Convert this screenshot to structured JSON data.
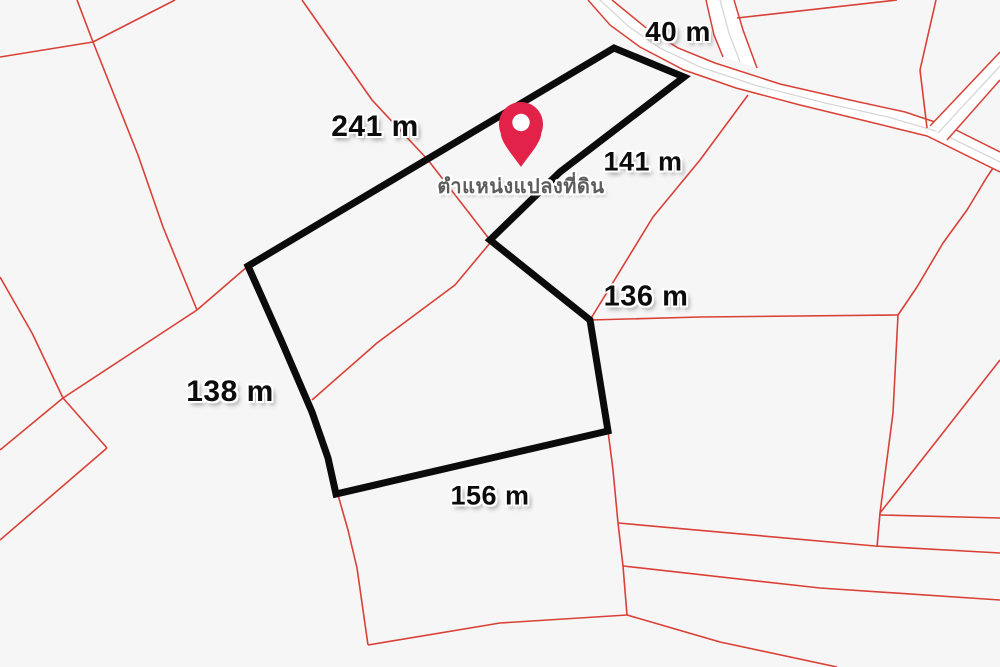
{
  "map": {
    "background_color": "#f6f6f7",
    "boundary_line_color": "#d94036",
    "road_fill_color": "#ffffff",
    "road_centerline_color": "#d7d7da",
    "parcel_outline_color": "#0b0b0b",
    "pin_color": "#e32249",
    "parcel_outline": [
      [
        248,
        266
      ],
      [
        614,
        48
      ],
      [
        684,
        77
      ],
      [
        560,
        172
      ],
      [
        490,
        240
      ],
      [
        590,
        320
      ],
      [
        608,
        431
      ],
      [
        336,
        494
      ],
      [
        328,
        458
      ],
      [
        312,
        412
      ],
      [
        281,
        340
      ]
    ],
    "red_lines": [
      [
        [
          77,
          0
        ],
        [
          93,
          42
        ]
      ],
      [
        [
          175,
          0
        ],
        [
          93,
          42
        ]
      ],
      [
        [
          0,
          57
        ],
        [
          93,
          42
        ]
      ],
      [
        [
          93,
          42
        ],
        [
          138,
          155
        ],
        [
          163,
          227
        ],
        [
          197,
          310
        ]
      ],
      [
        [
          197,
          310
        ],
        [
          248,
          266
        ]
      ],
      [
        [
          197,
          310
        ],
        [
          63,
          398
        ]
      ],
      [
        [
          0,
          277
        ],
        [
          32,
          333
        ],
        [
          63,
          398
        ]
      ],
      [
        [
          63,
          398
        ],
        [
          0,
          450
        ]
      ],
      [
        [
          63,
          398
        ],
        [
          107,
          448
        ]
      ],
      [
        [
          107,
          448
        ],
        [
          0,
          540
        ]
      ],
      [
        [
          302,
          0
        ],
        [
          372,
          100
        ],
        [
          428,
          160
        ],
        [
          490,
          240
        ]
      ],
      [
        [
          490,
          240
        ],
        [
          590,
          320
        ]
      ],
      [
        [
          590,
          320
        ],
        [
          700,
          317
        ],
        [
          898,
          315
        ]
      ],
      [
        [
          490,
          243
        ],
        [
          455,
          285
        ],
        [
          377,
          343
        ],
        [
          312,
          400
        ]
      ],
      [
        [
          338,
          495
        ],
        [
          348,
          530
        ],
        [
          357,
          568
        ],
        [
          368,
          645
        ]
      ],
      [
        [
          368,
          645
        ],
        [
          500,
          623
        ],
        [
          627,
          615
        ]
      ],
      [
        [
          608,
          431
        ],
        [
          613,
          470
        ],
        [
          618,
          523
        ],
        [
          623,
          566
        ],
        [
          627,
          615
        ]
      ],
      [
        [
          627,
          615
        ],
        [
          720,
          642
        ],
        [
          837,
          667
        ]
      ],
      [
        [
          618,
          523
        ],
        [
          875,
          546
        ],
        [
          1000,
          553
        ]
      ],
      [
        [
          623,
          566
        ],
        [
          820,
          588
        ],
        [
          1000,
          600
        ]
      ],
      [
        [
          898,
          315
        ],
        [
          893,
          413
        ],
        [
          880,
          513
        ],
        [
          877,
          547
        ]
      ],
      [
        [
          880,
          513
        ],
        [
          1000,
          360
        ]
      ],
      [
        [
          880,
          515
        ],
        [
          1000,
          518
        ]
      ],
      [
        [
          898,
          315
        ],
        [
          917,
          287
        ],
        [
          943,
          243
        ],
        [
          967,
          210
        ],
        [
          987,
          177
        ],
        [
          993,
          168
        ]
      ],
      [
        [
          936,
          0
        ],
        [
          920,
          70
        ],
        [
          927,
          128
        ]
      ],
      [
        [
          737,
          18
        ],
        [
          897,
          0
        ]
      ],
      [
        [
          590,
          320
        ],
        [
          653,
          217
        ],
        [
          700,
          160
        ],
        [
          748,
          95
        ]
      ]
    ],
    "roads": [
      {
        "name": "main-road",
        "edge_a": [
          [
            612,
            0
          ],
          [
            645,
            27
          ],
          [
            678,
            48
          ],
          [
            715,
            63
          ],
          [
            780,
            84
          ],
          [
            850,
            100
          ],
          [
            905,
            112
          ],
          [
            950,
            127
          ],
          [
            1000,
            152
          ]
        ],
        "edge_b": [
          [
            588,
            0
          ],
          [
            610,
            25
          ],
          [
            640,
            47
          ],
          [
            684,
            70
          ],
          [
            736,
            88
          ],
          [
            800,
            105
          ],
          [
            870,
            122
          ],
          [
            927,
            136
          ],
          [
            1000,
            172
          ]
        ],
        "centerline": [
          [
            600,
            0
          ],
          [
            628,
            26
          ],
          [
            660,
            48
          ],
          [
            700,
            67
          ],
          [
            758,
            86
          ],
          [
            825,
            103
          ],
          [
            888,
            117
          ],
          [
            939,
            132
          ],
          [
            1000,
            162
          ]
        ]
      },
      {
        "name": "north-road",
        "edge_a": [
          [
            706,
            0
          ],
          [
            714,
            35
          ],
          [
            723,
            57
          ]
        ],
        "edge_b": [
          [
            734,
            0
          ],
          [
            743,
            30
          ],
          [
            757,
            68
          ]
        ],
        "centerline": [
          [
            720,
            0
          ],
          [
            729,
            33
          ],
          [
            740,
            62
          ]
        ]
      },
      {
        "name": "northeast-road",
        "edge_a": [
          [
            930,
            126
          ],
          [
            1000,
            52
          ]
        ],
        "edge_b": [
          [
            947,
            140
          ],
          [
            1000,
            80
          ]
        ],
        "centerline": [
          [
            938,
            133
          ],
          [
            1000,
            66
          ]
        ]
      }
    ],
    "labels": [
      {
        "text": "40 m",
        "x": 678,
        "y": 32,
        "size": 28,
        "kind": "measurement"
      },
      {
        "text": "241 m",
        "x": 375,
        "y": 127,
        "size": 30,
        "kind": "measurement"
      },
      {
        "text": "141 m",
        "x": 643,
        "y": 162,
        "size": 27,
        "kind": "measurement"
      },
      {
        "text": "136 m",
        "x": 646,
        "y": 297,
        "size": 29,
        "kind": "measurement"
      },
      {
        "text": "138 m",
        "x": 230,
        "y": 392,
        "size": 30,
        "kind": "measurement"
      },
      {
        "text": "156 m",
        "x": 490,
        "y": 496,
        "size": 27,
        "kind": "measurement"
      },
      {
        "text": "ตำแหน่งแปลงที่ดิน",
        "x": 521,
        "y": 186,
        "size": 20,
        "kind": "pin"
      }
    ],
    "pin": {
      "tip_x": 521,
      "tip_y": 167,
      "head_cx": 521,
      "head_cy": 124,
      "head_r": 22,
      "hole_r": 8.7
    }
  }
}
